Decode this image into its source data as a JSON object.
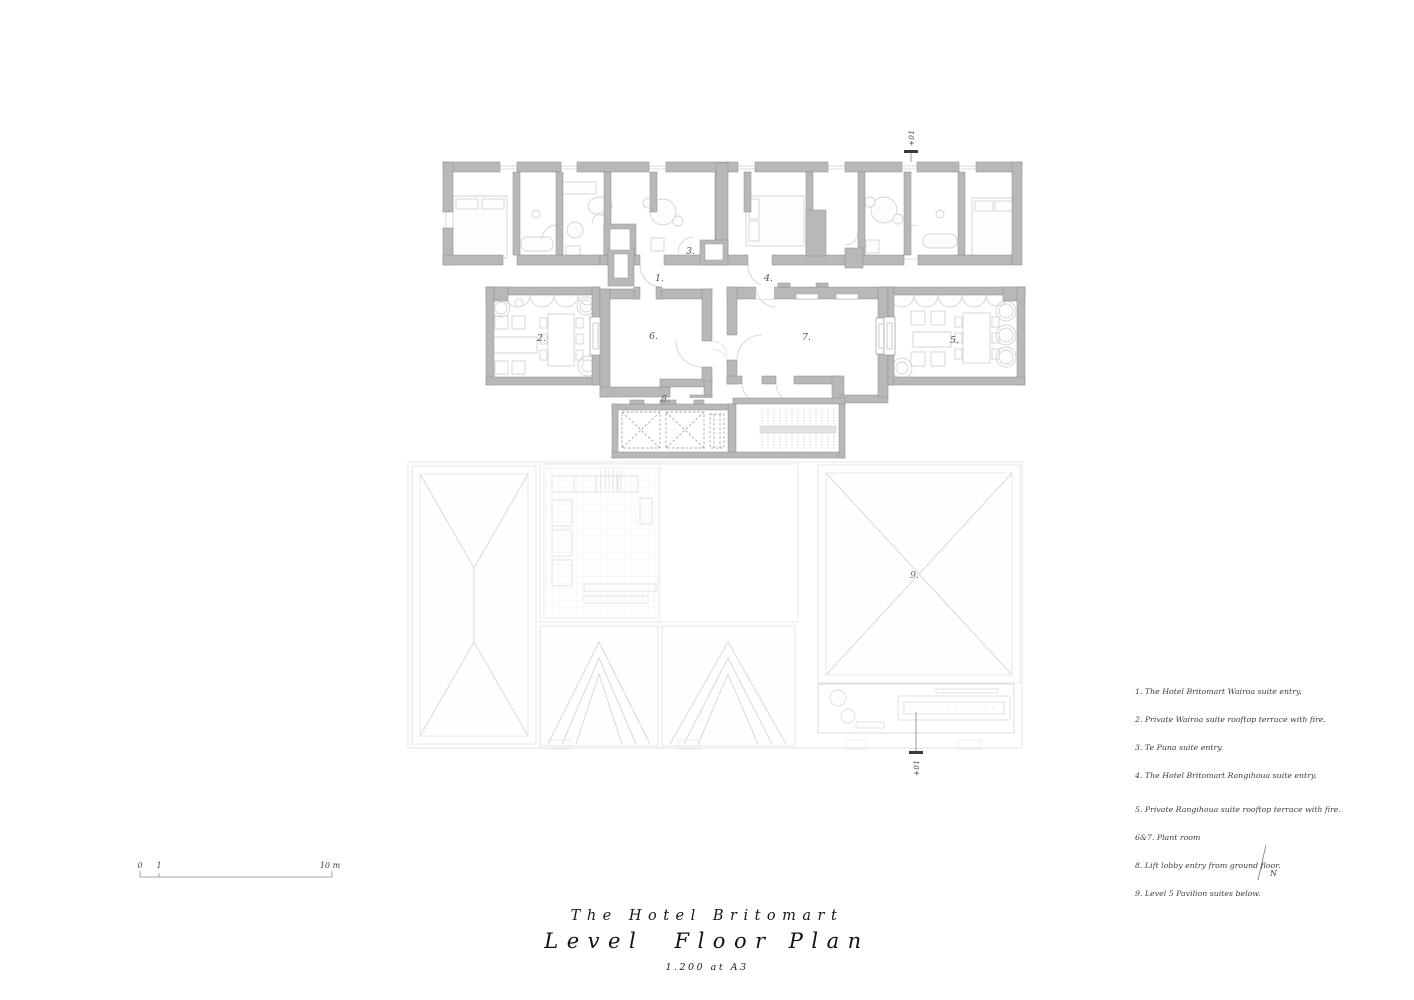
{
  "drawing": {
    "room_labels": {
      "n1": "1.",
      "n2": "2.",
      "n3": "3.",
      "n4": "4.",
      "n5": "5.",
      "n6": "6.",
      "n7": "7.",
      "n8": "8.",
      "n9": "9."
    },
    "section_marker": "+01"
  },
  "legend": {
    "lines": [
      "1. The Hotel Britomart Wairoa suite entry.",
      "2. Private Wairoa suite rooftop terrace with fire.",
      "3. Te Puna suite entry.",
      "4. The Hotel Britomart Rangihoua suite entry.",
      "5. Private Rangihoua suite rooftop terrace with fire.",
      "6&7. Plant room",
      "8. Lift lobby entry from ground floor.",
      "9. Level 5 Pavilion suites below."
    ]
  },
  "scale_bar": {
    "zero": "0",
    "one": "1",
    "ten": "10 m"
  },
  "north": {
    "label": "N"
  },
  "title_block": {
    "project": "The Hotel Britomart",
    "title": "Level  Floor Plan",
    "scale": "1.200 at A3"
  },
  "colors": {
    "wall": "#b8b8b8",
    "wall_outline": "#8d8d8d",
    "furniture": "#d3d3d3",
    "ghost": "#e6e6e6",
    "text": "#3d3d3d"
  }
}
